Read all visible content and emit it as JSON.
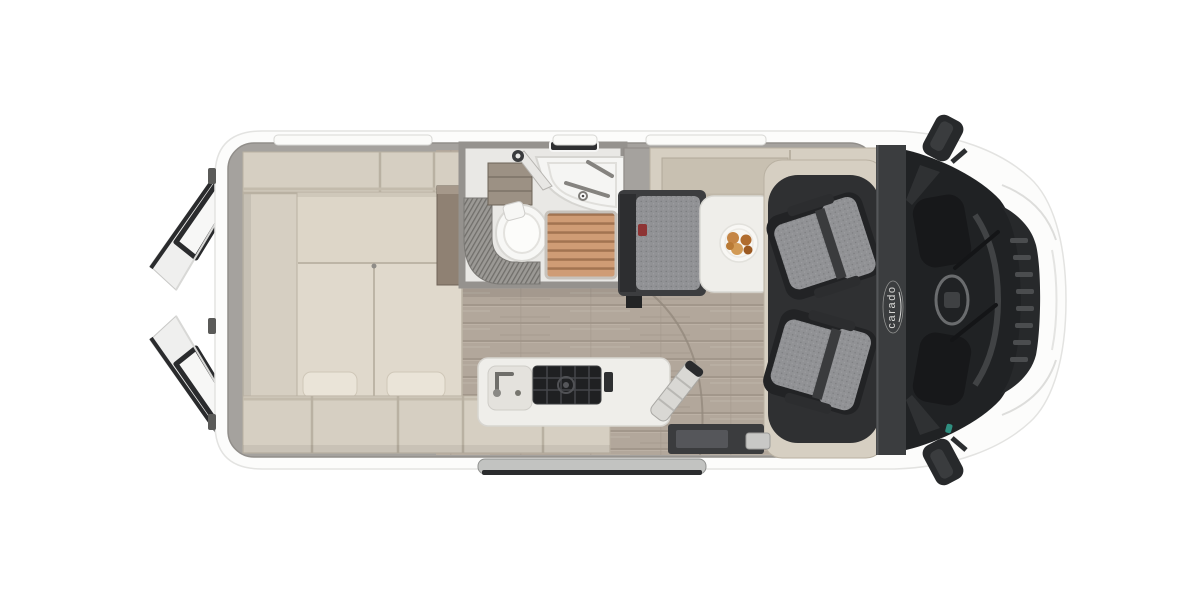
{
  "brand": {
    "logo_text": "carado"
  },
  "colors": {
    "body_white": "#fcfcfb",
    "wall_gray": "#a5a29e",
    "furniture_beige": "#d6cfc2",
    "furniture_inset": "#c8c0b1",
    "mattress": "#e0d9cc",
    "surface_white": "#efeeea",
    "cab_dark": "#2f3032",
    "glass": "#202224",
    "seat_gray": "#919295",
    "wood_floor": "#b2a79b",
    "shower_wood": "#cf9c75",
    "brand_silver": "#d8d8d6",
    "buckle_red": "#8e3434",
    "furniture_line": "#b5ad9e"
  }
}
